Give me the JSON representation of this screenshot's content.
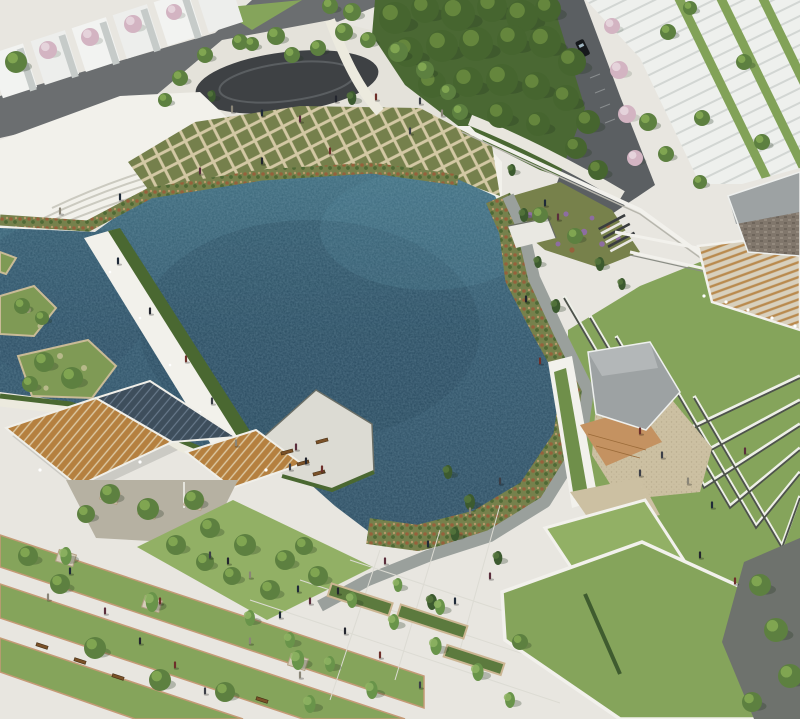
{
  "meta": {
    "description": "Aerial architectural rendering of a waterfront park: a large irregular pond ringed by wetland planting, a white promenade with steps, diamond-pattern rain gardens, a boardwalk bridge with hedge, planted islands, wooden pergola canopies over a plaza, a gray-roofed pavilion with wood deck and gravel court, chevron terraced lawns, white townhouse rows, roads, and tree-lined paved plazas with lawn bands and tiny pedestrians.",
    "view": "aerial"
  },
  "palette": {
    "paving": "#e8e6e0",
    "paving_bright": "#f2f1eb",
    "plaza_top": "#e4e2da",
    "road": "#6b6e70",
    "road_dark": "#5b5f62",
    "oval_court": "#3e4144",
    "forest_base": "#4a6833",
    "lawn": "#85a45b",
    "lawn_bright": "#92b065",
    "lawn_dark": "#6f9150",
    "water_top": "#3c6a7c",
    "water_mid": "#2e5268",
    "water_deep": "#27455a",
    "hedge": "#4a6831",
    "wood_pergola": "#b5803f",
    "wood_deck": "#c49261",
    "glass_canopy": "#3e4e5c",
    "roof_gray": "#9da2a3",
    "roof_light": "#b3b7b8",
    "stone_wall": "#81776c",
    "gravel_tan": "#ccc0a2",
    "gravel_gray": "#b6b1a2",
    "path_gravel": "#9aa09c",
    "dark_path": "#6e726d",
    "terrace_wall": "#4d524b",
    "white_wall": "#f2f1ec",
    "cherry_blossom": "#d6b7c4",
    "flower_purple": "#8d6da1",
    "flower_orange": "#c5873f",
    "stone_edge": "#c49a76",
    "car_body": "#16191c",
    "building_face": "#eef0ed"
  },
  "scene": {
    "regions": [
      {
        "name": "central-pond"
      },
      {
        "name": "wetland-edge"
      },
      {
        "name": "diamond-rain-garden"
      },
      {
        "name": "promenade-steps"
      },
      {
        "name": "boardwalk-bridge"
      },
      {
        "name": "planted-islands"
      },
      {
        "name": "pergola-plaza"
      },
      {
        "name": "viewing-deck"
      },
      {
        "name": "top-plaza-oval"
      },
      {
        "name": "forest-grove"
      },
      {
        "name": "townhouse-rows"
      },
      {
        "name": "stone-building"
      },
      {
        "name": "pavilion"
      },
      {
        "name": "terraced-lawns"
      },
      {
        "name": "lawn-bands-plaza"
      }
    ],
    "trees": [
      [
        395,
        18,
        16,
        "f"
      ],
      [
        425,
        9,
        14,
        "f"
      ],
      [
        458,
        14,
        17,
        "f"
      ],
      [
        492,
        7,
        15,
        "f"
      ],
      [
        522,
        16,
        16,
        "f"
      ],
      [
        548,
        9,
        13,
        "f"
      ],
      [
        408,
        52,
        15,
        "f"
      ],
      [
        442,
        46,
        16,
        "f"
      ],
      [
        476,
        44,
        17,
        "f"
      ],
      [
        512,
        40,
        15,
        "f"
      ],
      [
        545,
        42,
        16,
        "f"
      ],
      [
        572,
        62,
        14,
        "f"
      ],
      [
        432,
        84,
        14,
        "f"
      ],
      [
        468,
        82,
        15,
        "f"
      ],
      [
        502,
        80,
        16,
        "f"
      ],
      [
        536,
        86,
        14,
        "f"
      ],
      [
        566,
        98,
        13,
        "f"
      ],
      [
        588,
        122,
        12,
        "f"
      ],
      [
        500,
        115,
        13,
        "f"
      ],
      [
        538,
        124,
        12,
        "f"
      ],
      [
        576,
        148,
        11,
        "f"
      ],
      [
        598,
        170,
        10,
        "f"
      ],
      [
        276,
        36,
        9,
        "g"
      ],
      [
        292,
        55,
        8,
        "g"
      ],
      [
        318,
        48,
        8,
        "g"
      ],
      [
        344,
        32,
        9,
        "g"
      ],
      [
        368,
        40,
        8,
        "g"
      ],
      [
        398,
        52,
        10,
        "g"
      ],
      [
        425,
        70,
        9,
        "g"
      ],
      [
        448,
        92,
        8,
        "g"
      ],
      [
        460,
        112,
        8,
        "g"
      ],
      [
        180,
        78,
        8,
        "g"
      ],
      [
        205,
        55,
        8,
        "g"
      ],
      [
        240,
        42,
        8,
        "g"
      ],
      [
        212,
        96,
        6,
        "c"
      ],
      [
        352,
        98,
        7,
        "c"
      ],
      [
        165,
        100,
        7,
        "g"
      ],
      [
        352,
        12,
        9,
        "g"
      ],
      [
        330,
        6,
        8,
        "g"
      ],
      [
        16,
        62,
        11,
        "g"
      ],
      [
        48,
        50,
        9,
        "p"
      ],
      [
        90,
        37,
        9,
        "p"
      ],
      [
        133,
        24,
        9,
        "p"
      ],
      [
        174,
        12,
        8,
        "p"
      ],
      [
        252,
        44,
        7,
        "g"
      ],
      [
        612,
        26,
        8,
        "p"
      ],
      [
        619,
        70,
        9,
        "p"
      ],
      [
        627,
        114,
        9,
        "p"
      ],
      [
        635,
        158,
        8,
        "p"
      ],
      [
        668,
        32,
        8,
        "g"
      ],
      [
        702,
        118,
        8,
        "g"
      ],
      [
        744,
        62,
        8,
        "g"
      ],
      [
        762,
        142,
        8,
        "g"
      ],
      [
        690,
        8,
        7,
        "g"
      ],
      [
        648,
        122,
        9,
        "g"
      ],
      [
        666,
        154,
        8,
        "g"
      ],
      [
        700,
        182,
        7,
        "g"
      ],
      [
        512,
        170,
        6,
        "c"
      ],
      [
        524,
        215,
        7,
        "c"
      ],
      [
        538,
        262,
        6,
        "c"
      ],
      [
        556,
        306,
        7,
        "c"
      ],
      [
        600,
        264,
        7,
        "c"
      ],
      [
        622,
        284,
        6,
        "c"
      ],
      [
        540,
        215,
        8,
        "g"
      ],
      [
        575,
        236,
        8,
        "g"
      ],
      [
        448,
        472,
        7,
        "c"
      ],
      [
        470,
        502,
        8,
        "c"
      ],
      [
        455,
        534,
        7,
        "c"
      ],
      [
        498,
        558,
        7,
        "c"
      ],
      [
        432,
        602,
        8,
        "c"
      ],
      [
        520,
        642,
        8,
        "g"
      ],
      [
        760,
        585,
        11,
        "g"
      ],
      [
        776,
        630,
        12,
        "g"
      ],
      [
        790,
        676,
        12,
        "g"
      ],
      [
        752,
        702,
        10,
        "g"
      ],
      [
        44,
        362,
        10,
        "g"
      ],
      [
        72,
        378,
        11,
        "g"
      ],
      [
        30,
        384,
        8,
        "g"
      ],
      [
        22,
        306,
        8,
        "g"
      ],
      [
        42,
        318,
        7,
        "g"
      ],
      [
        28,
        556,
        10,
        "g"
      ],
      [
        60,
        584,
        10,
        "g"
      ],
      [
        95,
        648,
        11,
        "g"
      ],
      [
        160,
        680,
        11,
        "g"
      ],
      [
        225,
        692,
        10,
        "g"
      ],
      [
        205,
        562,
        9,
        "g"
      ],
      [
        110,
        494,
        10,
        "g"
      ],
      [
        148,
        509,
        11,
        "g"
      ],
      [
        194,
        500,
        10,
        "g"
      ],
      [
        86,
        514,
        9,
        "g"
      ],
      [
        176,
        545,
        10,
        "g"
      ],
      [
        210,
        528,
        10,
        "g"
      ],
      [
        245,
        545,
        11,
        "g"
      ],
      [
        285,
        560,
        10,
        "g"
      ],
      [
        318,
        576,
        10,
        "g"
      ],
      [
        232,
        576,
        9,
        "g"
      ],
      [
        270,
        590,
        10,
        "g"
      ],
      [
        304,
        546,
        9,
        "g"
      ],
      [
        250,
        618,
        8,
        "n"
      ],
      [
        290,
        640,
        8,
        "n"
      ],
      [
        330,
        664,
        8,
        "n"
      ],
      [
        372,
        690,
        9,
        "n"
      ],
      [
        352,
        600,
        8,
        "n"
      ],
      [
        394,
        622,
        8,
        "n"
      ],
      [
        436,
        646,
        9,
        "n"
      ],
      [
        478,
        672,
        9,
        "n"
      ],
      [
        398,
        585,
        7,
        "n"
      ],
      [
        440,
        607,
        8,
        "n"
      ],
      [
        310,
        704,
        9,
        "n"
      ],
      [
        510,
        700,
        8,
        "n"
      ],
      [
        66,
        556,
        9,
        "n"
      ],
      [
        152,
        602,
        10,
        "n"
      ],
      [
        298,
        660,
        10,
        "n"
      ]
    ],
    "people": [
      [
        150,
        312
      ],
      [
        186,
        360
      ],
      [
        212,
        402
      ],
      [
        236,
        444
      ],
      [
        118,
        262
      ],
      [
        296,
        448
      ],
      [
        306,
        462
      ],
      [
        322,
        470
      ],
      [
        290,
        468
      ],
      [
        60,
        212
      ],
      [
        120,
        198
      ],
      [
        200,
        172
      ],
      [
        262,
        162
      ],
      [
        330,
        152
      ],
      [
        410,
        132
      ],
      [
        232,
        110
      ],
      [
        262,
        114
      ],
      [
        300,
        120
      ],
      [
        336,
        100
      ],
      [
        376,
        98
      ],
      [
        420,
        102
      ],
      [
        442,
        114
      ],
      [
        545,
        204
      ],
      [
        558,
        218
      ],
      [
        526,
        300
      ],
      [
        540,
        362
      ],
      [
        500,
        482
      ],
      [
        470,
        512
      ],
      [
        428,
        545
      ],
      [
        385,
        562
      ],
      [
        338,
        592
      ],
      [
        640,
        432
      ],
      [
        662,
        456
      ],
      [
        688,
        482
      ],
      [
        712,
        506
      ],
      [
        745,
        452
      ],
      [
        700,
        556
      ],
      [
        735,
        582
      ],
      [
        640,
        474
      ],
      [
        48,
        598
      ],
      [
        70,
        572
      ],
      [
        105,
        612
      ],
      [
        140,
        642
      ],
      [
        175,
        666
      ],
      [
        205,
        692
      ],
      [
        250,
        642
      ],
      [
        280,
        616
      ],
      [
        310,
        602
      ],
      [
        345,
        632
      ],
      [
        380,
        656
      ],
      [
        420,
        686
      ],
      [
        300,
        676
      ],
      [
        455,
        602
      ],
      [
        490,
        577
      ],
      [
        228,
        562
      ],
      [
        160,
        602
      ],
      [
        210,
        556
      ],
      [
        250,
        576
      ],
      [
        298,
        590
      ]
    ],
    "planters": [
      [
        66,
        558
      ],
      [
        152,
        604
      ],
      [
        298,
        662
      ],
      [
        110,
        496
      ],
      [
        148,
        511
      ],
      [
        194,
        502
      ]
    ],
    "benches": [
      [
        287,
        452,
        -15
      ],
      [
        303,
        463,
        -15
      ],
      [
        319,
        473,
        -15
      ],
      [
        322,
        441,
        -15
      ],
      [
        42,
        646,
        18
      ],
      [
        80,
        661,
        18
      ],
      [
        118,
        677,
        18
      ],
      [
        262,
        700,
        18
      ]
    ]
  }
}
